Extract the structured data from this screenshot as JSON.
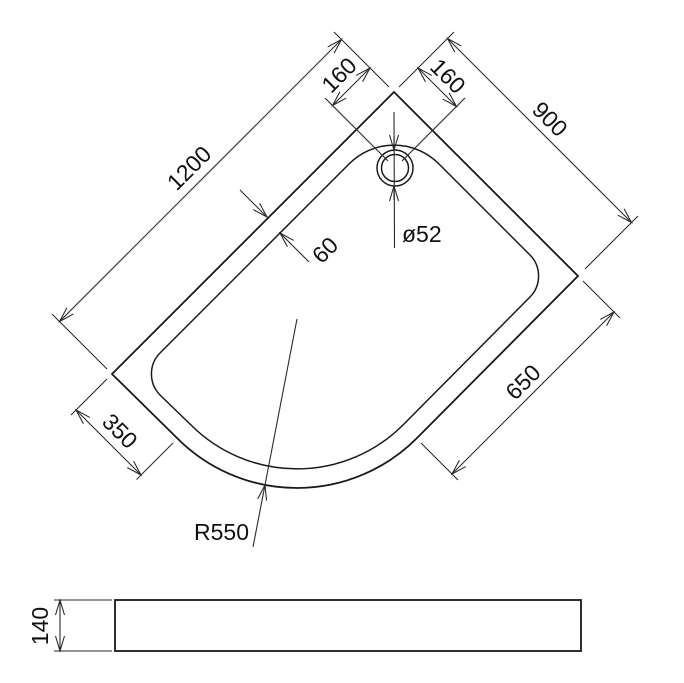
{
  "drawing": {
    "type": "technical-drawing",
    "subject": "quadrant shower tray",
    "background_color": "#ffffff",
    "line_color": "#1a1a1a"
  },
  "plan": {
    "dim_1200": "1200",
    "dim_900": "900",
    "dim_160_left": "160",
    "dim_160_right": "160",
    "dim_650": "650",
    "dim_350": "350",
    "dim_rim": "60",
    "dim_radius": "R550",
    "dim_drain": "ø52"
  },
  "side": {
    "dim_height": "140"
  }
}
